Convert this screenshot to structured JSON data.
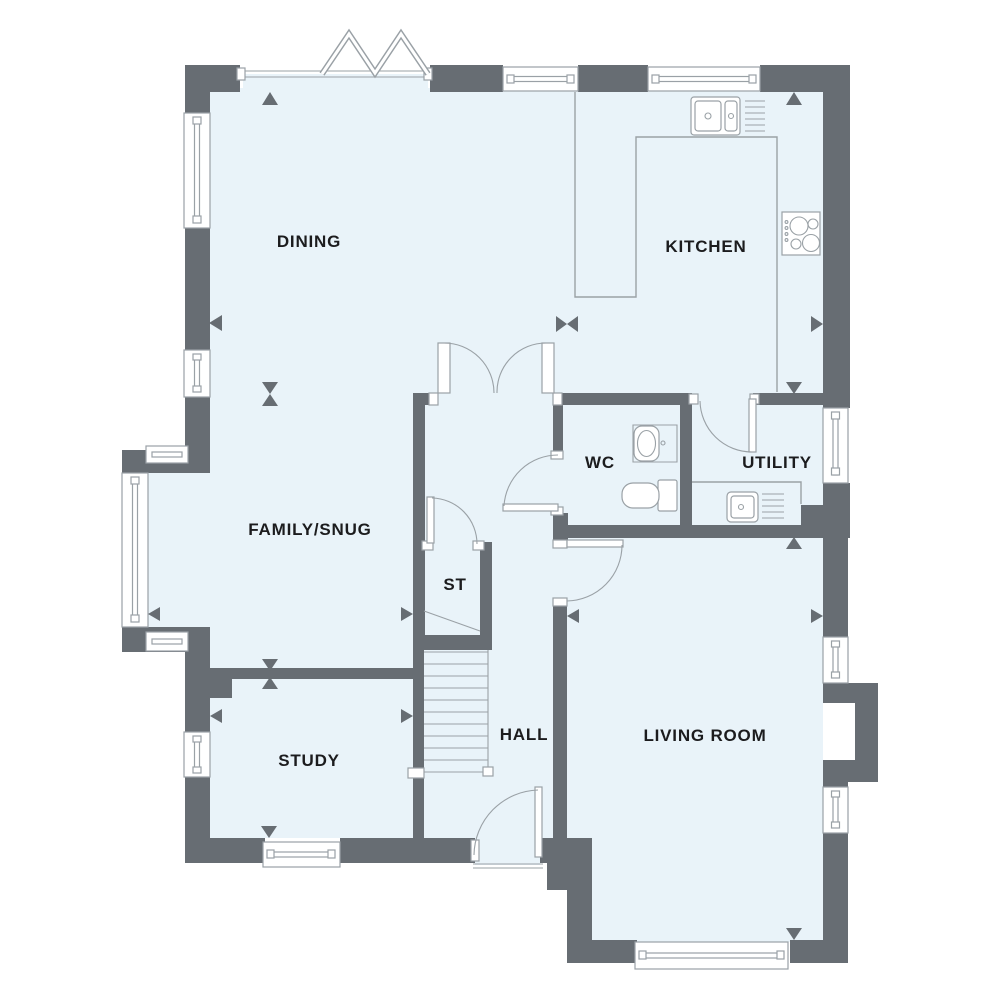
{
  "floorplan": {
    "rooms": [
      {
        "id": "dining",
        "label": "DINING"
      },
      {
        "id": "kitchen",
        "label": "KITCHEN"
      },
      {
        "id": "family-snug",
        "label": "FAMILY/SNUG"
      },
      {
        "id": "wc",
        "label": "WC"
      },
      {
        "id": "utility",
        "label": "UTILITY"
      },
      {
        "id": "storage",
        "label": "ST"
      },
      {
        "id": "hall",
        "label": "HALL"
      },
      {
        "id": "study",
        "label": "STUDY"
      },
      {
        "id": "living-room",
        "label": "LIVING ROOM"
      }
    ],
    "fixtures": [
      "bi-fold-door",
      "double-sink",
      "drainer",
      "hob",
      "utility-sink",
      "wash-basin",
      "toilet",
      "staircase",
      "bay-window",
      "chimney-breast"
    ],
    "colors": {
      "wall": "#676d73",
      "floor": "#e9f3f9",
      "line": "#9aa1a6",
      "text": "#1c1c1e",
      "background": "#ffffff"
    }
  }
}
